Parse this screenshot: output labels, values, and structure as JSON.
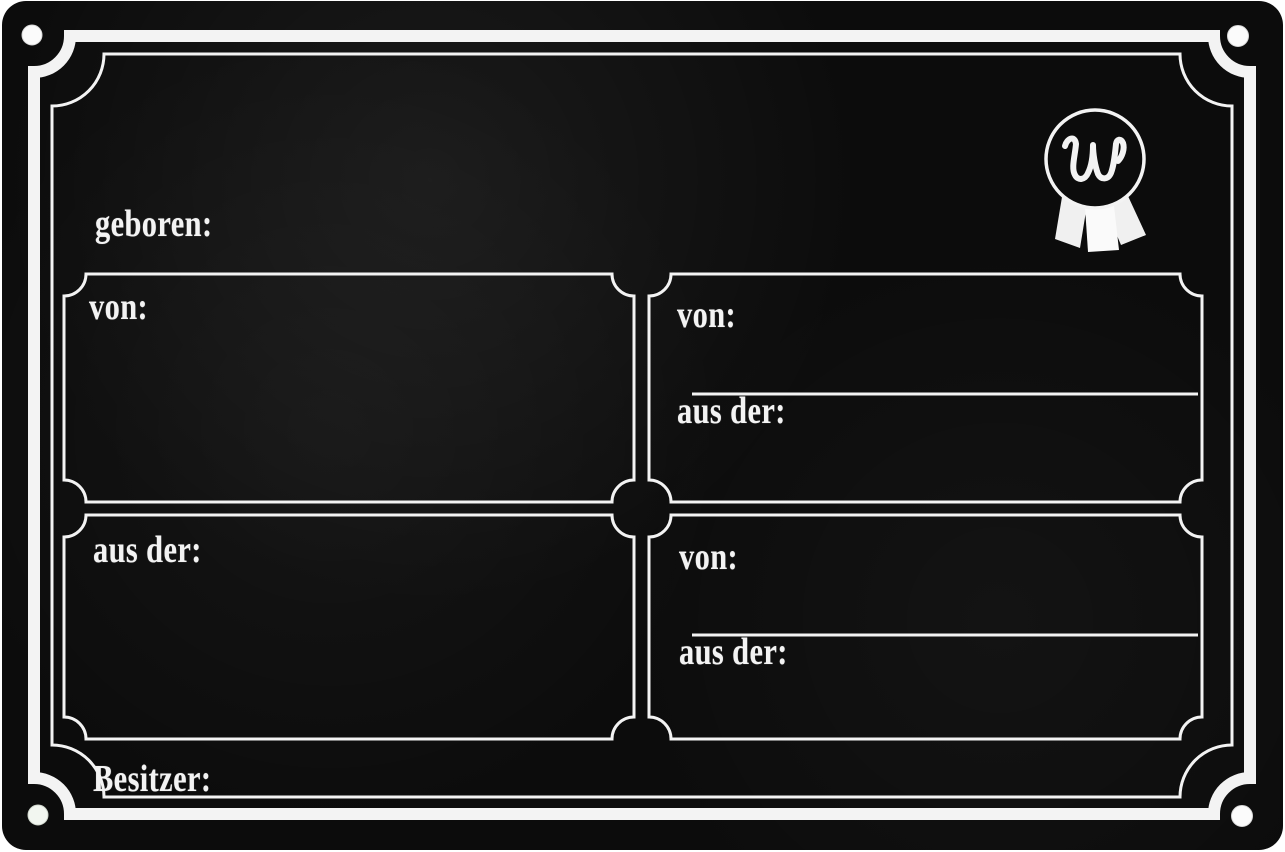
{
  "plate": {
    "born_label": "geboren:",
    "owner_label": "Besitzer:",
    "logo": {
      "letter": "W"
    },
    "panels": {
      "sire_top_left": {
        "label": "von:"
      },
      "dam_bottom_left": {
        "label": "aus der:"
      },
      "pedigree_top_right": {
        "sire_label": "von:",
        "dam_label": "aus der:"
      },
      "pedigree_bottom_right": {
        "sire_label": "von:",
        "dam_label": "aus der:"
      }
    },
    "colors": {
      "plate_background": "#0c0c0c",
      "frame_and_text": "#f3f3f3"
    }
  }
}
